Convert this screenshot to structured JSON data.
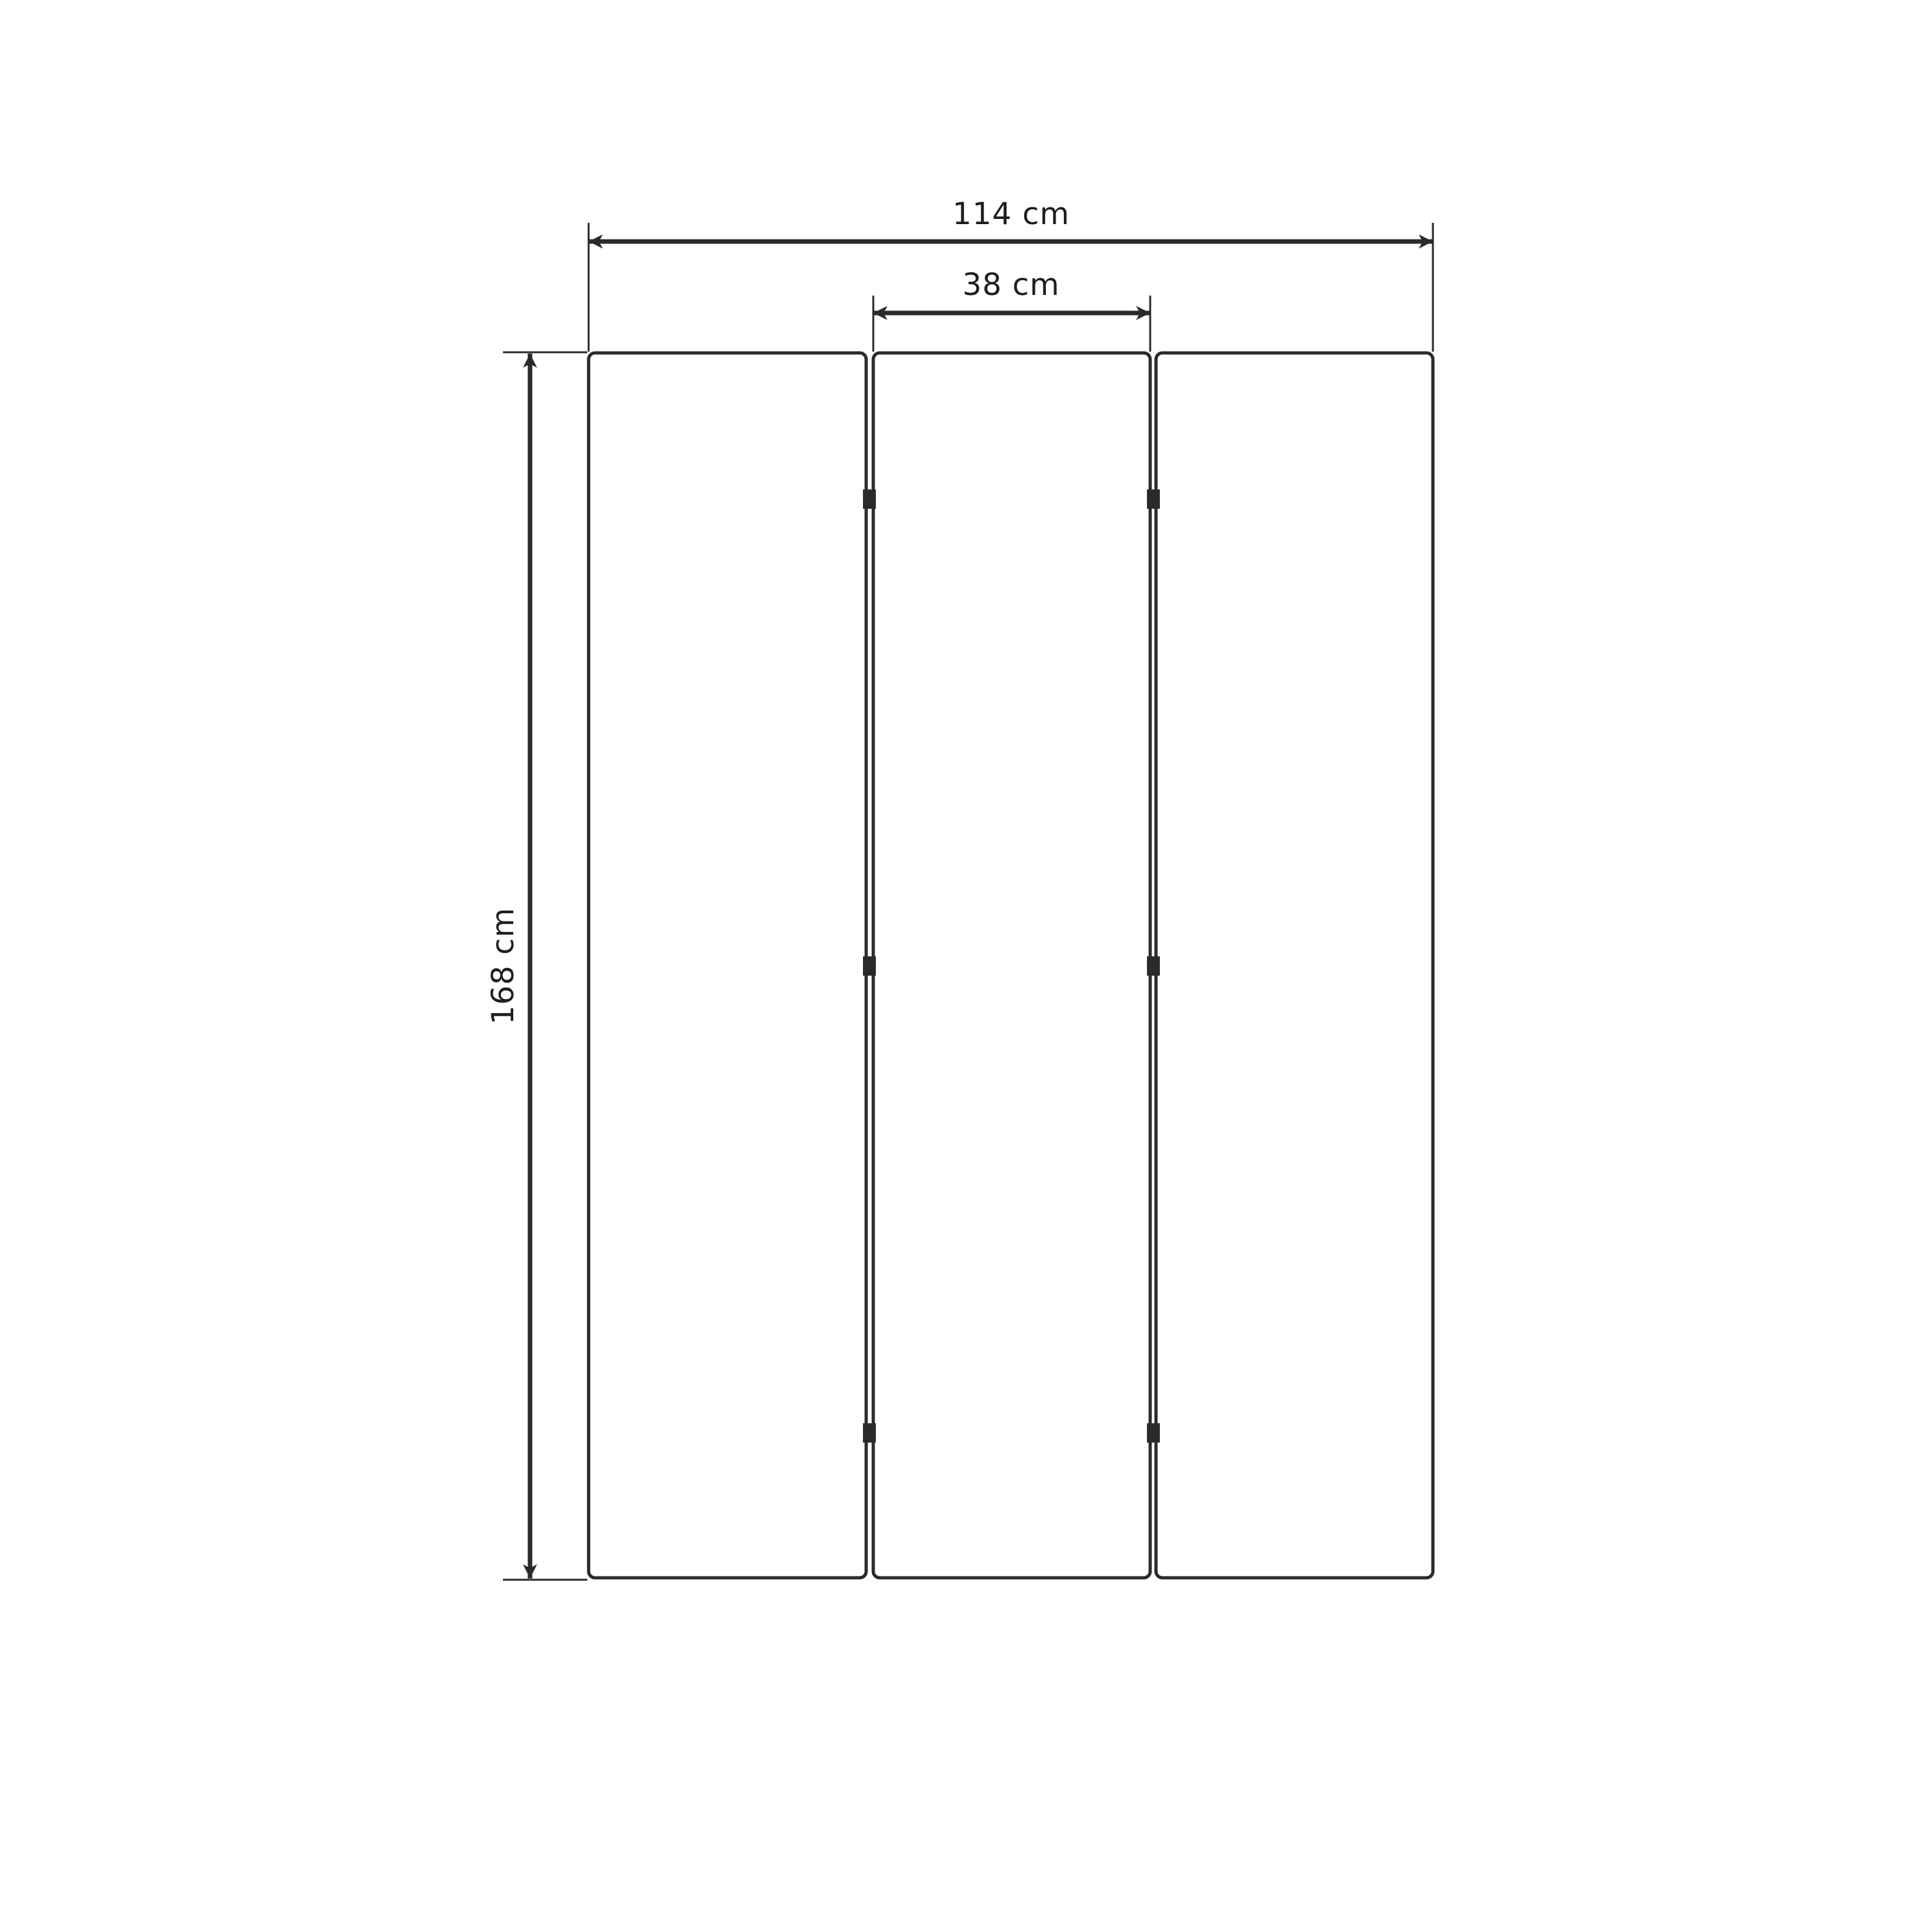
{
  "diagram": {
    "panels": {
      "count": 3,
      "hinge_rows_per_gap": 3
    },
    "dimensions": {
      "total_width": {
        "label": "114 cm",
        "value": 114,
        "unit": "cm"
      },
      "panel_width": {
        "label": "38 cm",
        "value": 38,
        "unit": "cm"
      },
      "height": {
        "label": "168 cm",
        "value": 168,
        "unit": "cm"
      }
    }
  },
  "colors": {
    "background": "#ffffff",
    "line": "#2b2a28",
    "text": "#1f1e1c"
  }
}
